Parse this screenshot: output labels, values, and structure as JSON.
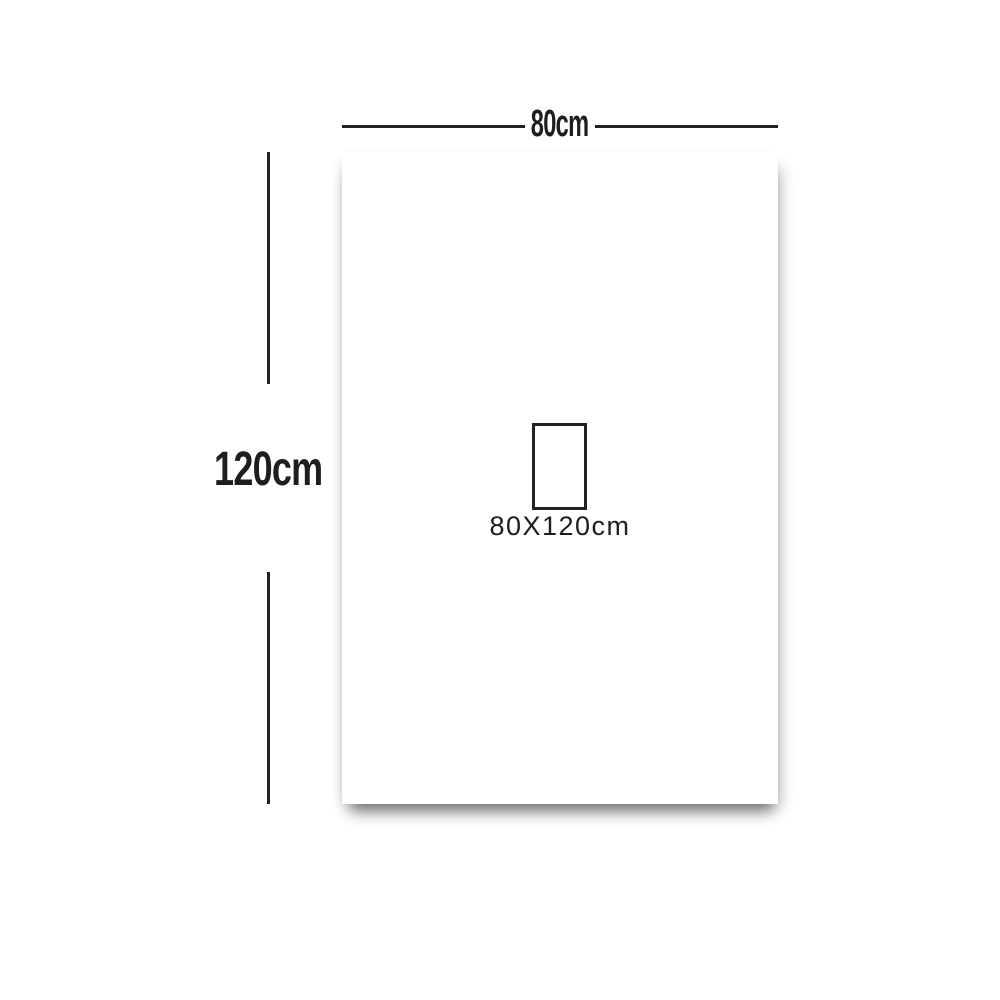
{
  "diagram": {
    "title": "product-size-diagram",
    "width_dimension": {
      "label": "80cm"
    },
    "height_dimension": {
      "label": "120cm"
    },
    "size_swatch": {
      "label": "80X120cm"
    },
    "colors": {
      "background": "#ffffff",
      "panel": "#ffffff",
      "line": "#222222",
      "text": "#1e1e1e"
    }
  }
}
